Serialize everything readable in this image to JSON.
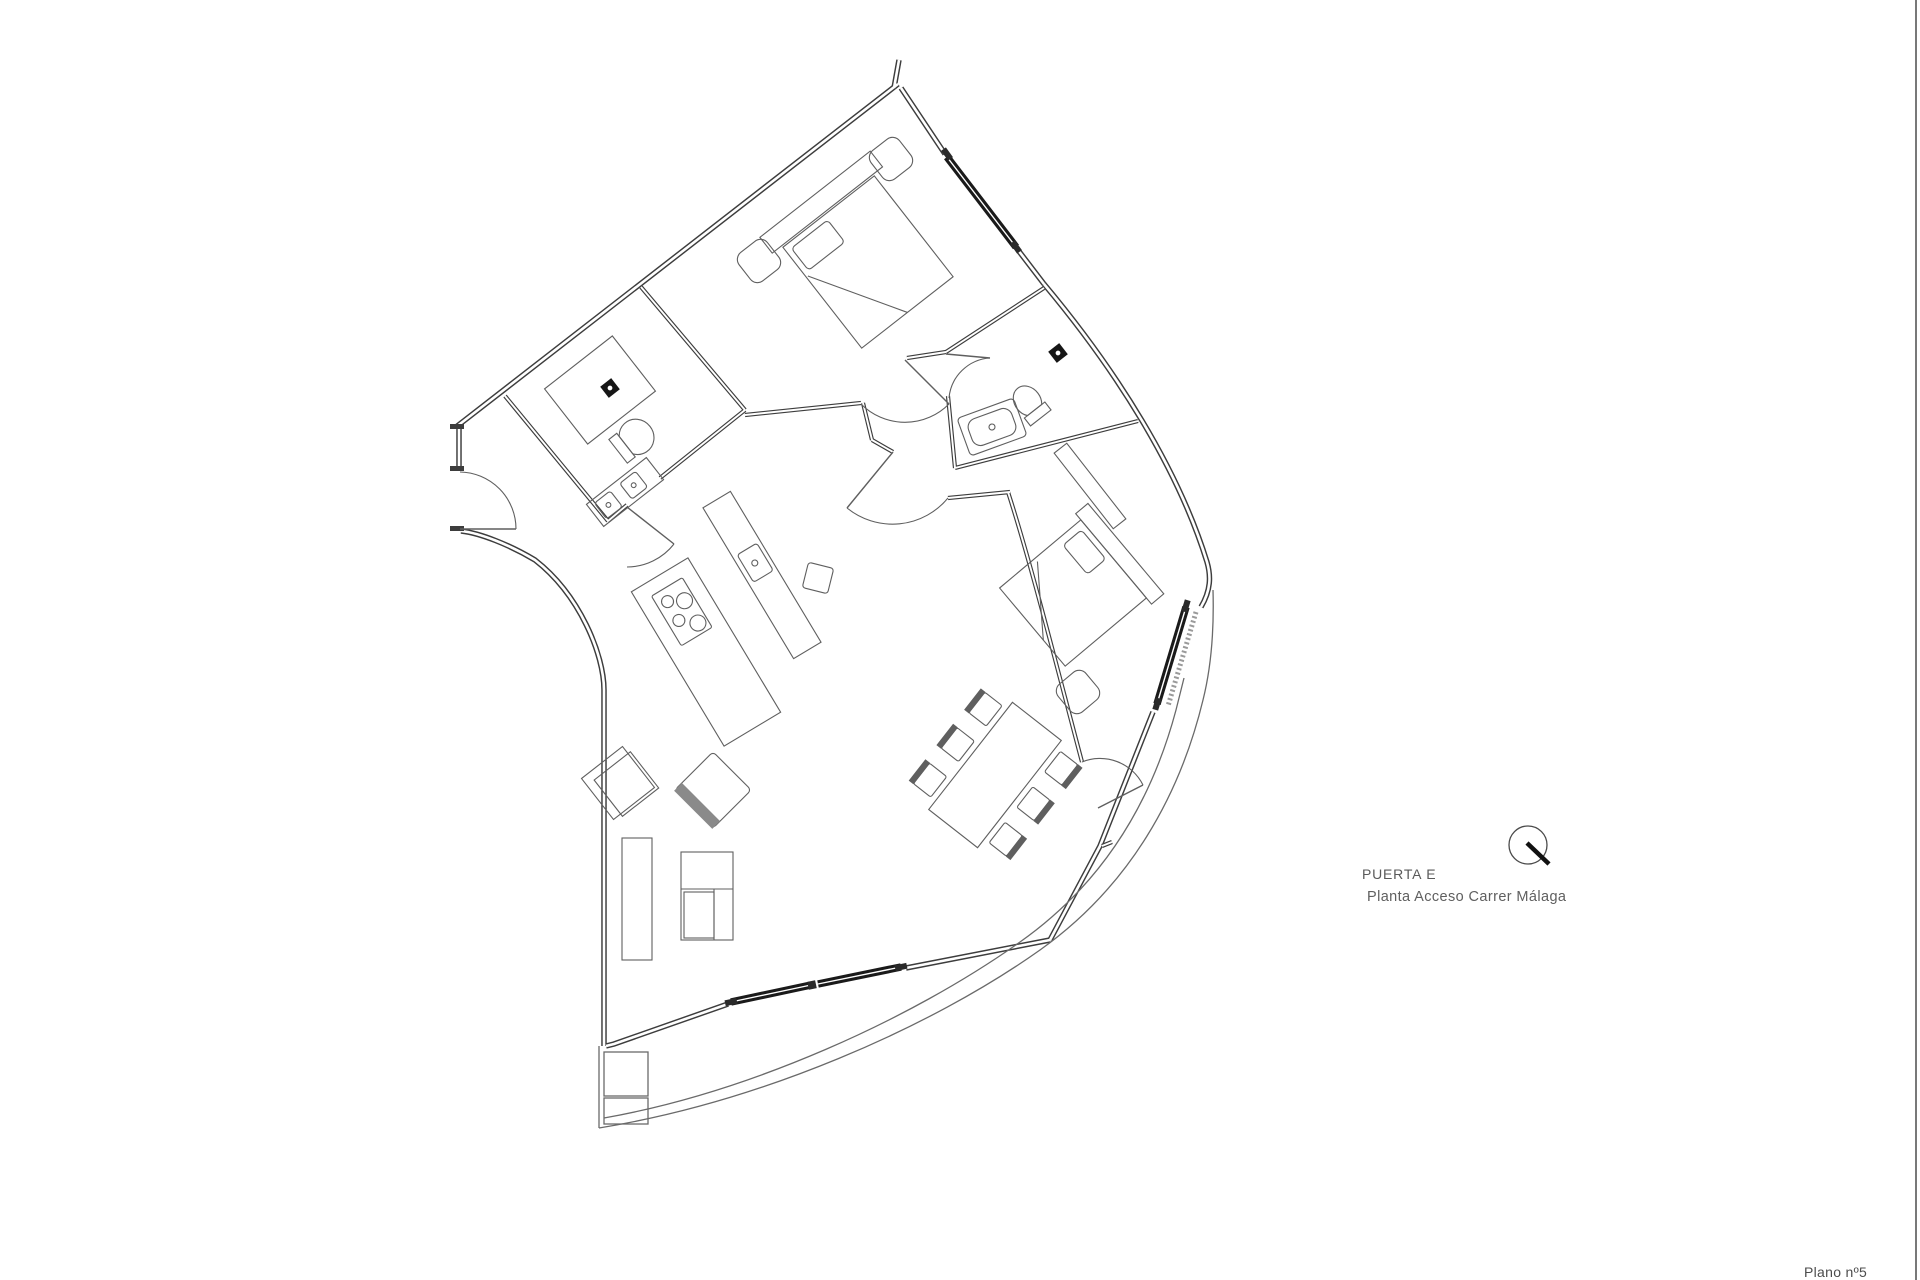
{
  "sheet": {
    "background": "#ffffff",
    "border_color": "#787878",
    "number_label": "Plano nº5"
  },
  "annotation": {
    "title": "PUERTA E",
    "subtitle": "Planta Acceso Carrer Málaga",
    "text_color": "#5a5a5a",
    "compass_icon": "north-indicator-icon"
  },
  "plan": {
    "wall_color": "#3d3d3d",
    "window_color": "#1a1a1a",
    "furniture_color": "#5f5f5f",
    "terrace_line_color": "#6a6a6a"
  }
}
